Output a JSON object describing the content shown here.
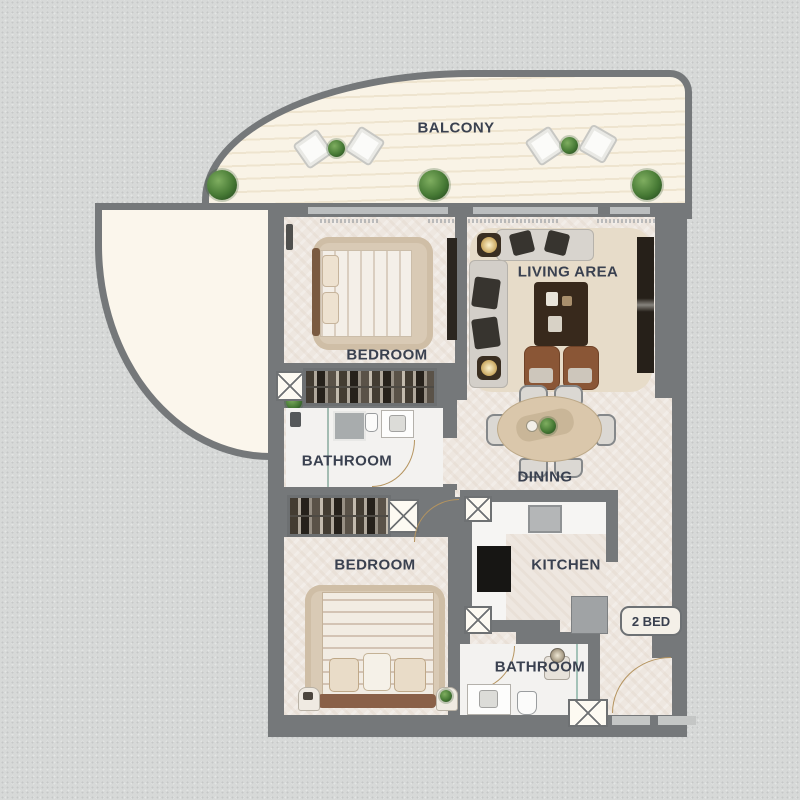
{
  "plan": {
    "type": "apartment-floor-plan",
    "badge_label": "2 BED",
    "rooms": {
      "balcony": "BALCONY",
      "bedroom1": "BEDROOM",
      "living": "LIVING AREA",
      "bathroom1": "BATHROOM",
      "dining": "DINING",
      "bedroom2": "BEDROOM",
      "kitchen": "KITCHEN",
      "bathroom2": "BATHROOM"
    },
    "colors": {
      "background": "#d7d9d8",
      "wall": "#75787a",
      "floor": "#eee7e0",
      "balcony_floor": "#f7f1e3",
      "terrace_floor": "#fbf6ec",
      "wet_room_floor": "#f3f2f0",
      "label_text": "#3a4150",
      "door_arc": "#b5945f",
      "plant_green": "#477a35",
      "wood_brown": "#7a5a40"
    },
    "icons": {
      "plant-icon": "green radial circle",
      "lounge-chair-icon": "white rounded square",
      "shaft-icon": "white box with X",
      "bed-icon": "mattress with headboard and pillows",
      "sofa-icon": "L-shaped gray seat",
      "tv-icon": "dark wall panel",
      "lamp-icon": "dark square with glowing disc",
      "dining-table-icon": "oval table with six chairs",
      "stove-icon": "black square with burners",
      "sink-icon": "white box with basin",
      "door-arc-icon": "tan quarter-circle swing"
    }
  }
}
